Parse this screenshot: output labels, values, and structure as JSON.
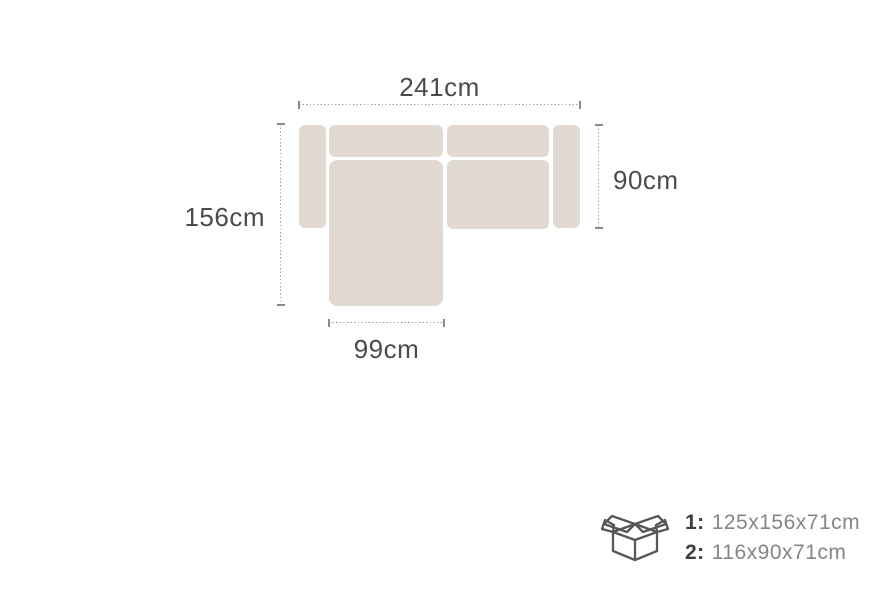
{
  "diagram": {
    "width_label": "241cm",
    "depth_label": "156cm",
    "seat_depth_label": "90cm",
    "chaise_width_label": "99cm"
  },
  "packaging": {
    "items": [
      {
        "label": "1:",
        "value": "125x156x71cm"
      },
      {
        "label": "2:",
        "value": "116x90x71cm"
      }
    ]
  },
  "icons": {
    "box": "open-cardboard-box-icon"
  },
  "colors": {
    "sofa_fill": "#e0dad3",
    "dimension_text": "#4b4b4b",
    "package_label_text": "#3f3f3f",
    "package_value_text": "#858585",
    "dotted_line": "#9b9b9b",
    "tick": "#8a8a8a",
    "icon_stroke": "#575757",
    "background": "#ffffff"
  }
}
